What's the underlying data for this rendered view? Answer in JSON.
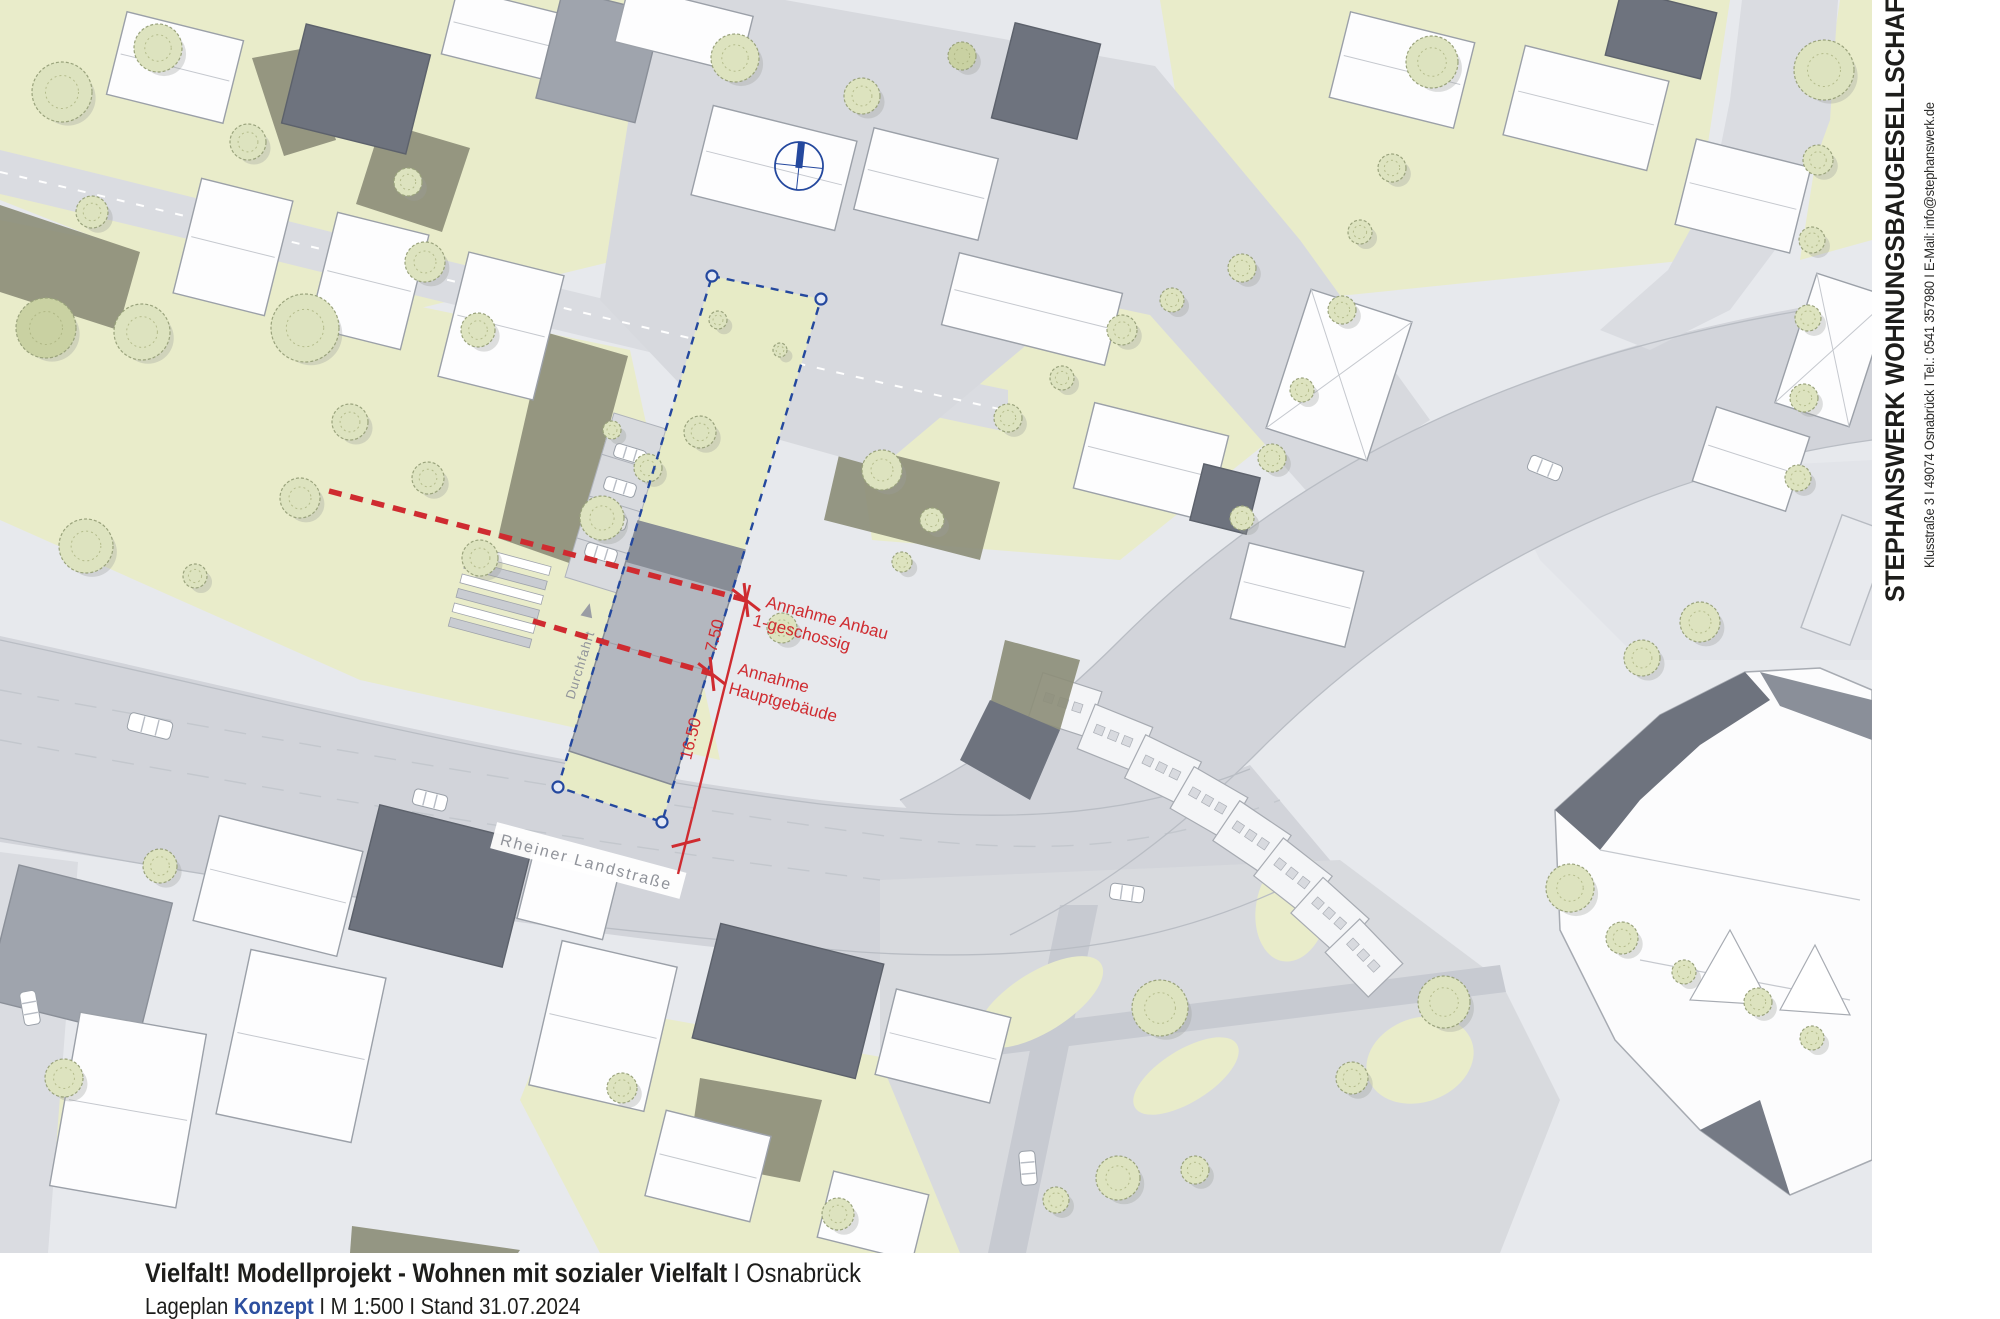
{
  "map": {
    "street_label": "Rheiner Landstraße",
    "lane_label": "Durchfahrt",
    "annotation_anbau_line1": "Annahme Anbau",
    "annotation_anbau_line2": "1-geschossig",
    "annotation_haupt_line1": "Annahme",
    "annotation_haupt_line2": "Hauptgebäude",
    "dimension_upper": "7.50",
    "dimension_lower": "16.50"
  },
  "company_panel": {
    "name": "STEPHANSWERK WOHNUNGSBAUGESELLSCHAFT mbH",
    "contact": "Klusstraße 3 I 49074 Osnabrück I Tel.: 0541 357980 I E-Mail: info@stephanswerk.de"
  },
  "title_block": {
    "project_title": "Vielfalt! Modellprojekt - Wohnen mit sozialer Vielfalt",
    "separator": "I",
    "city": "Osnabrück",
    "doc_type": "Lageplan",
    "doc_phase": "Konzept",
    "scale_and_date": "I M 1:500 I Stand 31.07.2024"
  },
  "colors": {
    "accent-blue": "#24489e",
    "annotation-red": "#cf2b30",
    "konzept-blue": "#2d4f9f",
    "garden-green": "#e9ecca",
    "olive": "#8d8e79",
    "road-grey": "#d2d4da",
    "title-black": "#1d1d1b"
  }
}
